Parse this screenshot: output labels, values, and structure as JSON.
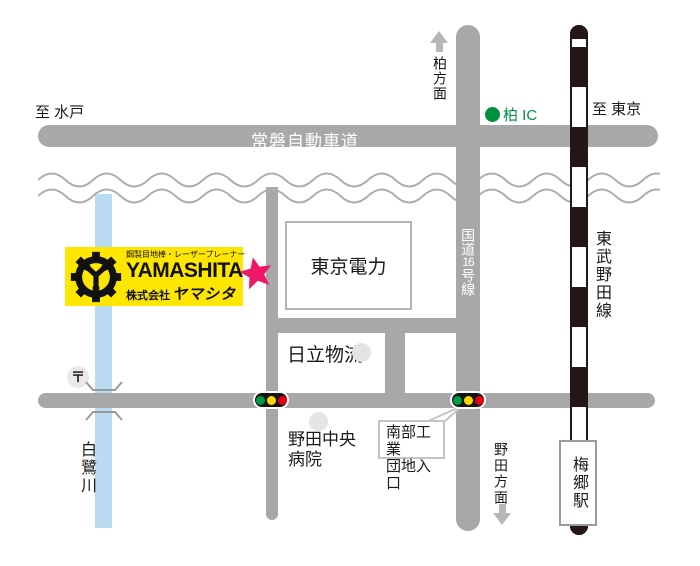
{
  "colors": {
    "road_gray": "#a8a8a8",
    "rail_dark": "#231815",
    "river_blue": "#b9dcf3",
    "brand_yellow": "#ffe600",
    "star_pink": "#ee1768",
    "ic_green": "#00913e",
    "signal_green": "#009944",
    "signal_yellow": "#ffd800",
    "signal_red": "#e60012"
  },
  "expressway": {
    "name": "常磐自動車道"
  },
  "route16": {
    "name": "国道16号線",
    "parts": [
      "国道",
      "16",
      "号線"
    ]
  },
  "railway": {
    "line_name": "東武野田線",
    "station_name": "梅郷駅"
  },
  "directions": {
    "west": "至 水戸",
    "east": "至 東京",
    "north": "柏方面",
    "south": "野田方面"
  },
  "interchange": {
    "name": "柏 IC"
  },
  "landmarks": {
    "tepco": "東京電力",
    "hitachi": "日立物流",
    "hospital_line1": "野田中央",
    "hospital_line2": "病院",
    "industrial_line1": "南部工業",
    "industrial_line2": "団地入口",
    "post_symbol": "〒"
  },
  "river": {
    "name": "白鷺川"
  },
  "company": {
    "tagline": "鋼製目地棒・レーザープレーナー",
    "name_en": "YAMASHITA",
    "name_prefix": "株式会社",
    "name_kana": "ヤマシタ"
  }
}
